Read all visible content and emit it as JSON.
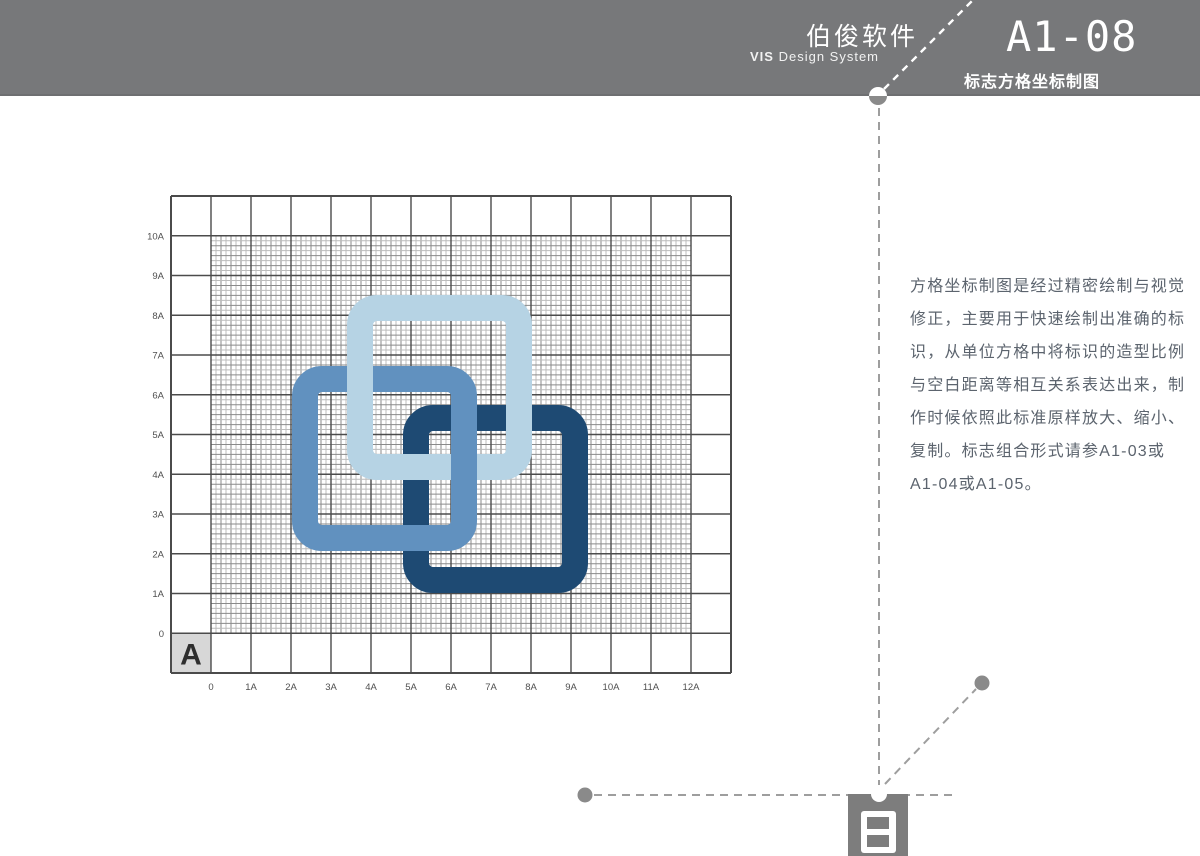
{
  "header": {
    "company": "伯俊软件",
    "system_bold": "VIS",
    "system_rest": " Design System",
    "code": "A1-08",
    "subtitle": "标志方格坐标制图",
    "bar_color": "#77787a"
  },
  "description": {
    "lines": [
      "方格坐标制图是经过精密绘制与视觉",
      "修正，主要用于快速绘制出准确的标",
      "识，从单位方格中将标识的造型比例",
      "与空白距离等相互关系表达出来，制",
      "作时候依照此标准原样放大、缩小、",
      "复制。标志组合形式请参A1-03或",
      "A1-04或A1-05。",
      "text_color",
      "#5c646e"
    ]
  },
  "diagram": {
    "corner_label": "A",
    "y_axis_labels": [
      "10A",
      "9A",
      "8A",
      "7A",
      "6A",
      "5A",
      "4A",
      "3A",
      "2A",
      "1A",
      "0"
    ],
    "x_axis_labels": [
      "0",
      "1A",
      "2A",
      "3A",
      "4A",
      "5A",
      "6A",
      "7A",
      "8A",
      "9A",
      "10A",
      "11A",
      "12A"
    ],
    "label_color": "#4f4f4f",
    "grid_color_major": "#4b4b4b",
    "grid_color_mid": "#8a8a8a",
    "grid_color_fine": "#bcbcbc",
    "corner_cell_bg": "#d7d7d7",
    "corner_label_color": "#2e2e2e",
    "logo_colors": {
      "light": "#b6d3e4",
      "medium": "#6191bf",
      "dark": "#1e4a73"
    }
  },
  "guides": {
    "dash_color": "#9e9e9e",
    "header_dash_color": "#ffffff",
    "dot_color": "#8a8a8a",
    "mark_square_color": "#7d7d7d"
  }
}
